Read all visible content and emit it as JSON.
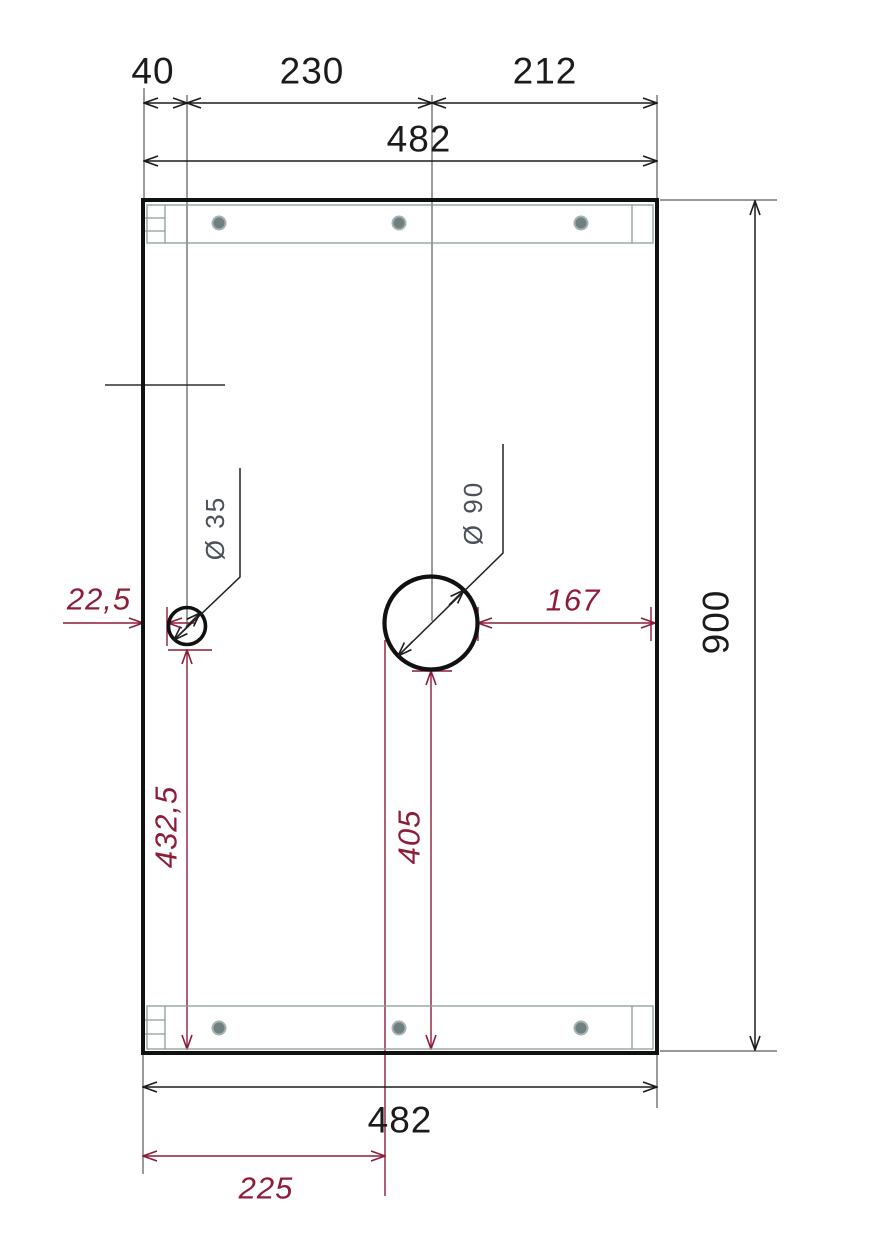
{
  "drawing": {
    "kind": "panel-dimension-drawing",
    "panel": {
      "width_label": "482",
      "height_label": "900"
    },
    "holes": {
      "small": {
        "diameter": "Ø 35",
        "left_offset": "22,5",
        "bottom_offset": "432,5"
      },
      "large": {
        "diameter": "Ø 90",
        "right_offset": "167",
        "bottom_offset": "405",
        "left_edge_offset": "225"
      }
    }
  },
  "labels": {
    "top_chain": [
      {
        "label": "40"
      },
      {
        "label": "230"
      },
      {
        "label": "212"
      }
    ],
    "top_overall": "482",
    "right_height": "900",
    "bottom_overall": "482",
    "bottom_offset": "225",
    "small_hole_left": "22,5",
    "small_hole_bottom": "432,5",
    "large_hole_right": "167",
    "large_hole_bottom": "405",
    "diameter_small": "Ø 35",
    "diameter_large": "Ø 90"
  },
  "colors": {
    "line_black": "#1b1b1b",
    "dimension_red": "#8e1c38",
    "diameter_text_gray": "#4b515a",
    "rail_gray": "#8e9a9a",
    "screw_fill": "#708080",
    "screw_ring": "#a5b2b2"
  }
}
